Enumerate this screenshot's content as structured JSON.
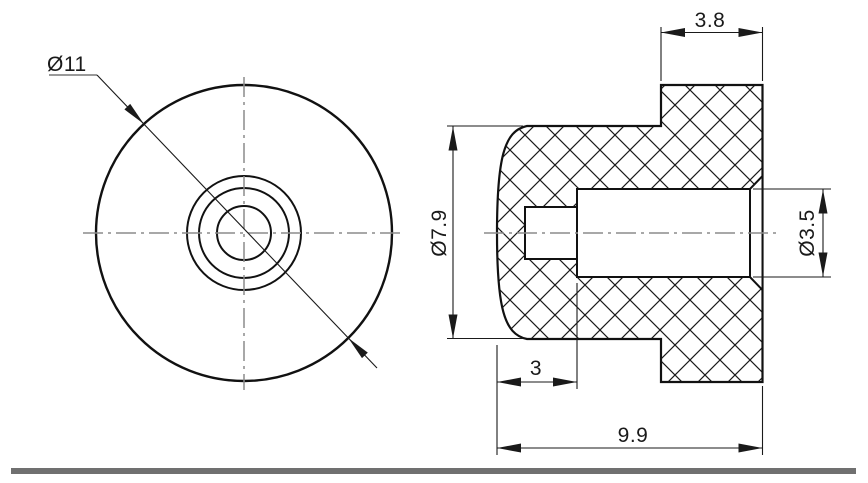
{
  "drawing": {
    "kind": "engineering section drawing",
    "part": "round flanged bumper with stepped center bore",
    "views": {
      "front_view": "circular view with flange circle, bore chamfer circle, bore circle and pocket circle",
      "section_view": "cross-hatched side section with domed face, flange and stepped bore"
    },
    "dimensions": {
      "front_diameter": "Ø11",
      "flange_width": "3.8",
      "body_diameter": "Ø7.9",
      "bore_diameter": "Ø3.5",
      "counterbore_depth": "3",
      "overall_length": "9.9"
    },
    "colors": {
      "line": "#111111",
      "dimension_line": "#1a1a1a",
      "centerline": "#8c8c8c",
      "leader_shoulder": "#999999",
      "separator_bar": "#707070",
      "background": "#ffffff",
      "hatch": "#1a1a1a"
    }
  }
}
